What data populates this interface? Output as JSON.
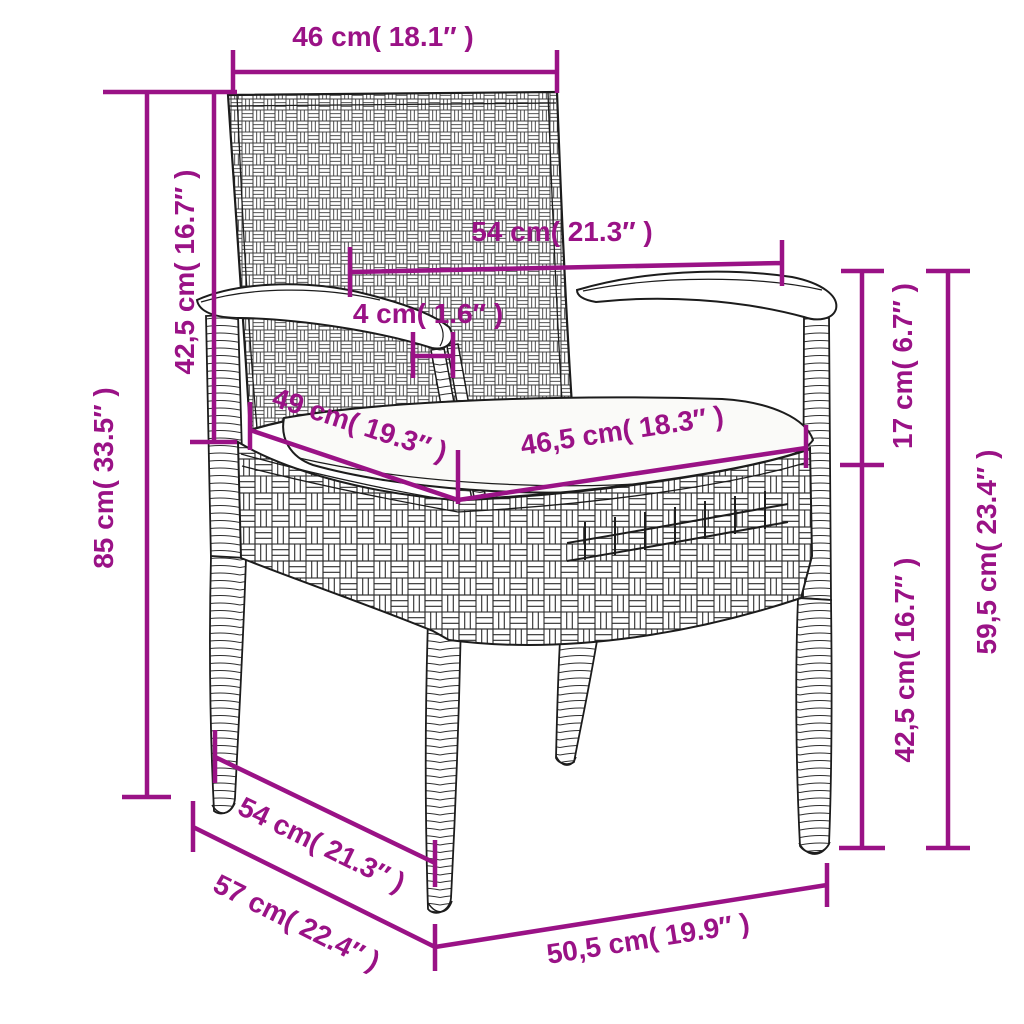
{
  "diagram": {
    "subject": "wicker garden armchair with seat cushion — dimension drawing",
    "colors": {
      "accent": "#9A1286",
      "line_art": "#1c1c1c",
      "cushion": "#fafaf8",
      "background": "#ffffff"
    },
    "dims": {
      "back_width": "46 cm( 18.1″ )",
      "backrest_height": "42,5 cm( 16.7″ )",
      "total_height": "85 cm( 33.5″ )",
      "armrest_span": "54 cm( 21.3″ )",
      "armrest_thickness": "4 cm( 1.6″ )",
      "seat_depth": "49 cm( 19.3″ )",
      "seat_width": "46,5 cm( 18.3″ )",
      "armrest_above_seat": "17 cm( 6.7″ )",
      "armrest_height": "59,5 cm( 23.4″ )",
      "seat_height": "42,5 cm( 16.7″ )",
      "base_depth": "54 cm( 21.3″ )",
      "base_depth_outer": "57 cm( 22.4″ )",
      "front_width": "50,5 cm( 19.9″ )"
    }
  }
}
